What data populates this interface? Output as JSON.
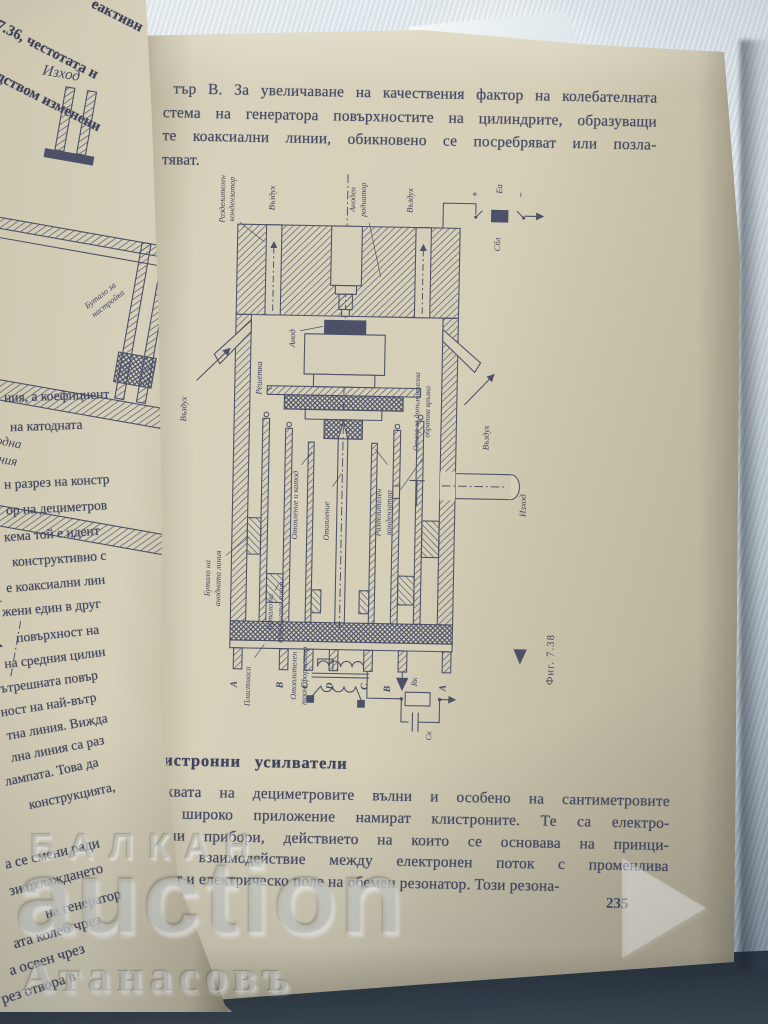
{
  "watermark": {
    "brand_top": "БАЛКАН",
    "brand_main": "auction",
    "brand_bottom": "Атанасовъ"
  },
  "left_page": {
    "flap_lines": [
      "еактивн",
      ". 7.36, честотата н",
      "редством изменени"
    ],
    "diagram": {
      "output": "Изход",
      "piston_1": "Бутало за",
      "piston_2": "настройка",
      "anode_line_1": "Анодна",
      "anode_line_2": "линия",
      "formula_l": "ℓ <",
      "formula_lambda": "λ",
      "formula_4": "4"
    },
    "fragments": [
      "ния, а коефициент",
      "на катодната",
      "н разрез на констр",
      "ор на дециметров",
      "кема той е идент",
      "конструктивно с",
      "е коаксиални лин",
      "жени един в друг",
      "повърхност на",
      "на средния цилин",
      "ътрешната повър",
      "ност на най-вътр",
      "тна линия. Вижда",
      "лна линия са раз",
      "лампата. Това да",
      "конструкцията,",
      "а се смени ради",
      "зи охлаждането",
      "на генератор",
      "ата колеб чрез",
      "а освен чрез",
      "рез отвора в"
    ]
  },
  "right_page": {
    "top_paragraph": [
      "тър В. За увеличаване на качествения фактор на колебателната",
      "стема на генератора повърхностите на цилиндрите, образуващи",
      "те коаксиални линии, обикновено се посребряват или позла-",
      "тяват."
    ],
    "heading": "Клистронни усилватели",
    "bottom_paragraph": [
      "В обхвата на дециметровите вълни и особено на сантиметровите",
      "вълни широко приложение намират клистроните. Те са електро-",
      "вакуумни прибори, действието на които се основава на принци-",
      "па на взаимодействие между електронен поток с променлива",
      "плътност и електрическо поле на обемен резонатор. Този резона-"
    ],
    "page_number": "235",
    "figure": {
      "caption": "Фиг. 7.38",
      "labels": {
        "sep_cap_1": "Разделителен",
        "sep_cap_2": "кондензатор",
        "air": "Въздух",
        "radiator_1": "Аноден",
        "radiator_2": "радиатор",
        "plus": "+",
        "ea": "Еа",
        "minus": "−",
        "cbl": "Сбл",
        "anode": "Анод",
        "grid": "Решетка",
        "heat_cath": "Отопление и катод",
        "heat": "Отопление",
        "sep_cap2_1": "Разделителен",
        "sep_cap2_2": "кондензатор",
        "hole_1": "Отвор за допълнителна",
        "hole_2": "обратна връзка",
        "piston_a_1": "Бутало на",
        "piston_a_2": "анодната линия",
        "piston_k_1": "Бутало на",
        "piston_k_2": "катодната линия",
        "output": "Изход",
        "plastic": "Пластмаса",
        "transformer_1": "Отоплителен",
        "transformer_2": "трансформатор",
        "t1": "А",
        "t2": "В",
        "t3": "С",
        "t4": "D",
        "t5": "С",
        "t6": "В",
        "t7": "А",
        "rk": "Rк",
        "ck": "Ск"
      }
    }
  }
}
